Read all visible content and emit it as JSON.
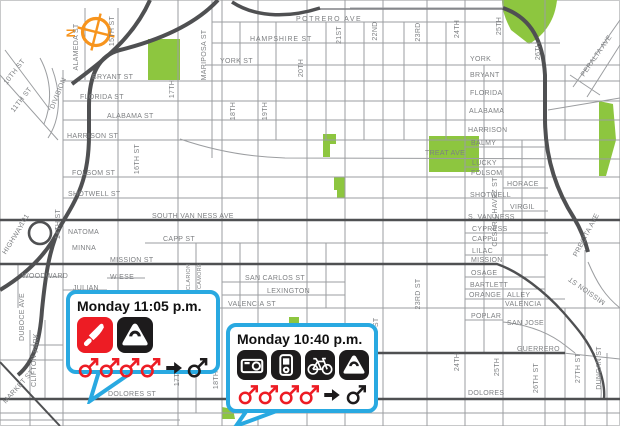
{
  "colors": {
    "park": "#8dc63f",
    "road_dark": "#4f5052",
    "road_thin": "#9b9da0",
    "label": "#7e8083",
    "callout_border": "#29a9e1",
    "incident_red": "#ed1c24",
    "incident_black": "#1d1b1c",
    "compass_orange": "#f7941d"
  },
  "compass": {
    "label": "N"
  },
  "callouts": [
    {
      "time": "Monday 11:05 p.m.",
      "item_icons": [
        {
          "name": "knife-icon",
          "bg": "#ed1c24"
        },
        {
          "name": "purse-icon",
          "bg": "#1d1b1c"
        }
      ],
      "attacker_count": 4,
      "victim_count": 1
    },
    {
      "time": "Monday 10:40 p.m.",
      "item_icons": [
        {
          "name": "camera-icon",
          "bg": "#1d1b1c"
        },
        {
          "name": "media-player-icon",
          "bg": "#1d1b1c"
        },
        {
          "name": "bicycle-icon",
          "bg": "#1d1b1c"
        },
        {
          "name": "purse-icon",
          "bg": "#1d1b1c"
        }
      ],
      "attacker_count": 4,
      "victim_count": 1
    }
  ],
  "map": {
    "labels": [
      {
        "t": "POTRERO  AVE",
        "x": 296,
        "y": 21,
        "ls": 1.5
      },
      {
        "t": "HAMPSHIRE   ST",
        "x": 250,
        "y": 41,
        "ls": 0.8
      },
      {
        "t": "YORK  ST",
        "x": 220,
        "y": 63
      },
      {
        "t": "BRYANT  ST",
        "x": 92,
        "y": 79
      },
      {
        "t": "FLORIDA  ST",
        "x": 80,
        "y": 99
      },
      {
        "t": "ALABAMA  ST",
        "x": 107,
        "y": 118
      },
      {
        "t": "HARRISON  ST",
        "x": 67,
        "y": 138
      },
      {
        "t": "FOLSOM  ST",
        "x": 72,
        "y": 175
      },
      {
        "t": "SHOTWELL  ST",
        "x": 68,
        "y": 196
      },
      {
        "t": "SOUTH  VAN  NESS  AVE",
        "x": 152,
        "y": 218
      },
      {
        "t": "NATOMA",
        "x": 68,
        "y": 234
      },
      {
        "t": "MINNA",
        "x": 72,
        "y": 250
      },
      {
        "t": "CAPP  ST",
        "x": 163,
        "y": 241
      },
      {
        "t": "MISSION  ST",
        "x": 110,
        "y": 262
      },
      {
        "t": "WOODWARD",
        "x": 22,
        "y": 278
      },
      {
        "t": "WIESE",
        "x": 110,
        "y": 279
      },
      {
        "t": "JULIAN",
        "x": 73,
        "y": 290
      },
      {
        "t": "SAN  CARLOS  ST",
        "x": 245,
        "y": 280
      },
      {
        "t": "LEXINGTON",
        "x": 267,
        "y": 293
      },
      {
        "t": "VALENCIA  ST",
        "x": 228,
        "y": 306
      },
      {
        "t": "DOLORES  ST",
        "x": 108,
        "y": 396
      },
      {
        "t": "TREAT  AVE",
        "x": 425,
        "y": 155
      },
      {
        "t": "YORK",
        "x": 470,
        "y": 61
      },
      {
        "t": "BRYANT",
        "x": 470,
        "y": 77
      },
      {
        "t": "FLORIDA",
        "x": 470,
        "y": 95
      },
      {
        "t": "ALABAMA",
        "x": 469,
        "y": 113
      },
      {
        "t": "HARRISON",
        "x": 468,
        "y": 132
      },
      {
        "t": "BALMY",
        "x": 471,
        "y": 145
      },
      {
        "t": "LUCKY",
        "x": 472,
        "y": 165
      },
      {
        "t": "FOLSOM",
        "x": 471,
        "y": 175
      },
      {
        "t": "HORACE",
        "x": 507,
        "y": 186
      },
      {
        "t": "SHOTWELL",
        "x": 470,
        "y": 197
      },
      {
        "t": "VIRGIL",
        "x": 510,
        "y": 209
      },
      {
        "t": "S. VAN NESS",
        "x": 468,
        "y": 219
      },
      {
        "t": "CYPRESS",
        "x": 472,
        "y": 231
      },
      {
        "t": "CAPP",
        "x": 472,
        "y": 241
      },
      {
        "t": "LILAC",
        "x": 472,
        "y": 253
      },
      {
        "t": "MISSION",
        "x": 471,
        "y": 262
      },
      {
        "t": "OSAGE",
        "x": 471,
        "y": 275
      },
      {
        "t": "BARTLETT",
        "x": 470,
        "y": 287
      },
      {
        "t": "ORANGE",
        "x": 469,
        "y": 297
      },
      {
        "t": "ALLEY",
        "x": 507,
        "y": 297
      },
      {
        "t": "VALENCIA",
        "x": 505,
        "y": 306
      },
      {
        "t": "POPLAR",
        "x": 471,
        "y": 318
      },
      {
        "t": "SAN JOSE",
        "x": 507,
        "y": 325
      },
      {
        "t": "GUERRERO",
        "x": 517,
        "y": 351
      },
      {
        "t": "DOLORES",
        "x": 468,
        "y": 395
      },
      {
        "t": "10TH ST",
        "x": 16,
        "y": 73,
        "r": -52,
        "a": "m"
      },
      {
        "t": "11TH ST",
        "x": 23,
        "y": 101,
        "r": -52,
        "a": "m"
      },
      {
        "t": "DIVISION",
        "x": 60,
        "y": 94,
        "r": -68,
        "a": "m"
      },
      {
        "t": "ALAMEDA ST",
        "x": 78,
        "y": 47,
        "r": -90,
        "a": "m"
      },
      {
        "t": "15TH ST",
        "x": 114,
        "y": 31,
        "r": -90,
        "a": "m"
      },
      {
        "t": "MARIPOSA ST",
        "x": 206,
        "y": 55,
        "r": -90,
        "a": "m"
      },
      {
        "t": "17TH",
        "x": 174,
        "y": 89,
        "r": -90,
        "a": "m"
      },
      {
        "t": "18TH",
        "x": 235,
        "y": 111,
        "r": -90,
        "a": "m"
      },
      {
        "t": "19TH",
        "x": 267,
        "y": 111,
        "r": -90,
        "a": "m"
      },
      {
        "t": "20TH",
        "x": 303,
        "y": 68,
        "r": -90,
        "a": "m"
      },
      {
        "t": "21ST",
        "x": 341,
        "y": 35,
        "r": -90,
        "a": "m"
      },
      {
        "t": "22ND",
        "x": 377,
        "y": 31,
        "r": -90,
        "a": "m"
      },
      {
        "t": "23RD",
        "x": 420,
        "y": 32,
        "r": -90,
        "a": "m"
      },
      {
        "t": "24TH",
        "x": 459,
        "y": 29,
        "r": -90,
        "a": "m"
      },
      {
        "t": "25TH",
        "x": 501,
        "y": 26,
        "r": -90,
        "a": "m"
      },
      {
        "t": "26TH",
        "x": 540,
        "y": 51,
        "r": -90,
        "a": "m"
      },
      {
        "t": "16TH ST",
        "x": 139,
        "y": 159,
        "r": -90,
        "a": "m"
      },
      {
        "t": "14TH ST",
        "x": 60,
        "y": 224,
        "r": -90,
        "a": "m"
      },
      {
        "t": "HIGHWAY",
        "x": 15,
        "y": 240,
        "r": -58,
        "a": "m"
      },
      {
        "t": "101",
        "x": 26,
        "y": 221,
        "r": -58,
        "a": "m"
      },
      {
        "t": "DUBOCE AVE",
        "x": 24,
        "y": 317,
        "r": -90,
        "a": "m"
      },
      {
        "t": "PARK",
        "x": 38,
        "y": 343,
        "r": -90,
        "a": "m"
      },
      {
        "t": "CLIFTON",
        "x": 36,
        "y": 371,
        "r": -90,
        "a": "m"
      },
      {
        "t": "MARKET ST",
        "x": 20,
        "y": 388,
        "r": -48,
        "a": "m"
      },
      {
        "t": "CLARION",
        "x": 190,
        "y": 277,
        "r": -90,
        "a": "m",
        "s": 5.5
      },
      {
        "t": "SYCAMORE",
        "x": 201,
        "y": 280,
        "r": -90,
        "a": "m",
        "s": 5.5
      },
      {
        "t": "CESAR CHAVEZ ST",
        "x": 497,
        "y": 212,
        "r": -90,
        "a": "m"
      },
      {
        "t": "PRECITA AVE",
        "x": 588,
        "y": 236,
        "r": -62,
        "a": "m"
      },
      {
        "t": "PERALTA AVE",
        "x": 598,
        "y": 57,
        "r": -55,
        "a": "m"
      },
      {
        "t": "MISSION ST",
        "x": 588,
        "y": 289,
        "r": -145,
        "a": "m"
      },
      {
        "t": "22ND ST",
        "x": 378,
        "y": 333,
        "r": -90,
        "a": "m"
      },
      {
        "t": "23RD ST",
        "x": 420,
        "y": 294,
        "r": -90,
        "a": "m"
      },
      {
        "t": "24TH",
        "x": 459,
        "y": 362,
        "r": -90,
        "a": "m"
      },
      {
        "t": "25TH",
        "x": 499,
        "y": 367,
        "r": -90,
        "a": "m"
      },
      {
        "t": "26TH ST",
        "x": 538,
        "y": 378,
        "r": -90,
        "a": "m"
      },
      {
        "t": "27TH ST",
        "x": 580,
        "y": 368,
        "r": -90,
        "a": "m"
      },
      {
        "t": "DUNCAN ST",
        "x": 601,
        "y": 368,
        "r": -90,
        "a": "m"
      },
      {
        "t": "17TH",
        "x": 179,
        "y": 377,
        "r": -90,
        "a": "m"
      },
      {
        "t": "18TH ST",
        "x": 218,
        "y": 374,
        "r": -90,
        "a": "m"
      }
    ]
  }
}
